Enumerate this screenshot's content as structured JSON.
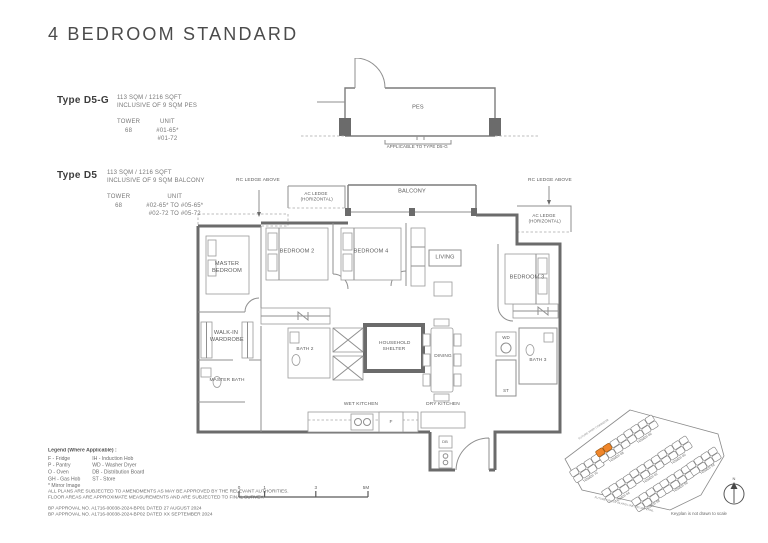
{
  "title": "4 BEDROOM STANDARD",
  "types": [
    {
      "name": "Type D5-G",
      "area": "113 SQM / 1216 SQFT",
      "inclusive": "INCLUSIVE OF 9 SQM PES",
      "tower_label": "TOWER",
      "tower": "68",
      "unit_label": "UNIT",
      "unit_line1": "#01-65*",
      "unit_line2": "#01-72"
    },
    {
      "name": "Type D5",
      "area": "113 SQM / 1216 SQFT",
      "inclusive": "INCLUSIVE OF 9 SQM BALCONY",
      "tower_label": "TOWER",
      "tower": "68",
      "unit_label": "UNIT",
      "unit_line1": "#02-65* TO #05-65*",
      "unit_line2": "#02-72 TO #05-72"
    }
  ],
  "plan": {
    "pes": "PES",
    "applicable_note": "APPLICABLE TO TYPE D5-G",
    "balcony": "BALCONY",
    "rc_ledge": "RC LEDGE ABOVE",
    "ac_ledge": "AC LEDGE (HORIZONTAL)",
    "rooms": {
      "master_bedroom": "MASTER BEDROOM",
      "bedroom_2": "BEDROOM 2",
      "bedroom_4": "BEDROOM 4",
      "living": "LIVING",
      "bedroom_3": "BEDROOM 3",
      "walk_in_wardrobe": "WALK-IN WARDROBE",
      "master_bath": "MASTER BATH",
      "bath_2": "BATH 2",
      "household_shelter": "HOUSEHOLD SHELTER",
      "dining": "DINING",
      "wd": "WD",
      "bath_3": "BATH 3",
      "st": "ST",
      "wet_kitchen": "WET KITCHEN",
      "dry_kitchen": "DRY KITCHEN",
      "fridge": "F",
      "db": "DB"
    }
  },
  "legend": {
    "heading": "Legend (Where Applicable) :",
    "col1": [
      "F - Fridge",
      "P - Pantry",
      "O - Oven",
      "GH - Gas Hob",
      "* Mirror Image"
    ],
    "col2": [
      "IH - Induction Hob",
      "WD - Washer Dryer",
      "DB - Distribution Board",
      "ST - Store"
    ]
  },
  "disclaimer": {
    "line1": "ALL PLANS ARE SUBJECTED TO AMENDMENTS AS MAY BE APPROVED BY THE RELEVANT AUTHORITIES.",
    "line2": "FLOOR AREAS ARE APPROXIMATE MEASUREMENTS AND ARE SUBJECTED TO FINAL SURVEY.",
    "line3": "BP APPROVAL NO. A1716-00038-2024-BP01   DATED 27 AUGUST 2024",
    "line4": "BP APPROVAL NO. A1716-00038-2024-BP02   DATED XX SEPTEMBER 2024"
  },
  "scalebar": {
    "t0": "0",
    "t1": "1",
    "t3": "3",
    "t5": "5M"
  },
  "keyplan": {
    "towers": [
      "TOWER 70",
      "TOWER 68",
      "TOWER 66",
      "TOWER 64",
      "TOWER 62",
      "TOWER 60",
      "TOWER 58",
      "TOWER 56",
      "TOWER 54"
    ],
    "note": "Keyplan is not drawn to scale",
    "compass_n": "N",
    "road_top": "FUTURE PARK CORRIDOR",
    "road_bottom": "FUTURE CROSS ISLAND LINE NATURE TRAIL",
    "highlight_color": "#F0862B"
  }
}
